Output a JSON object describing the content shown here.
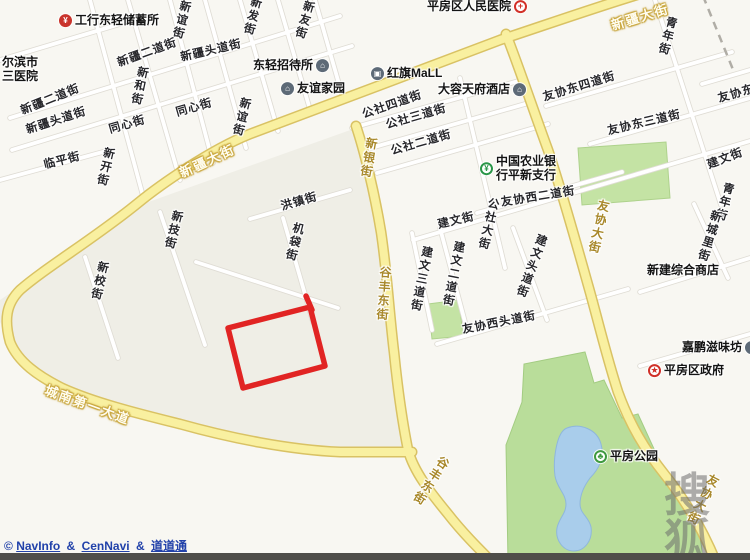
{
  "map": {
    "colors": {
      "road_fill": "#f9f0a0",
      "road_casing": "#d9c264",
      "minor_road": "#ffffff",
      "park_green": "#c4e3a4",
      "water_blue": "#a9cdeb",
      "annotation_red": "#e01212",
      "attribution_blue": "#2242aa",
      "watermark_gray": "#8a8a8a",
      "watermark_red": "#cc4430"
    },
    "annotation": {
      "type": "rectangle",
      "color": "#e01212"
    },
    "street_labels": [
      {
        "text": "新发街",
        "x": 252,
        "y": 16,
        "rot": 14,
        "vertical": true,
        "kind": "street"
      },
      {
        "text": "新谊街",
        "x": 181,
        "y": 20,
        "rot": 14,
        "vertical": true,
        "kind": "street"
      },
      {
        "text": "新友街",
        "x": 304,
        "y": 20,
        "rot": 16,
        "vertical": true,
        "kind": "street"
      },
      {
        "text": "新疆二道街",
        "x": 147,
        "y": 52,
        "rot": -20,
        "vertical": false,
        "kind": "street"
      },
      {
        "text": "新疆头道街",
        "x": 211,
        "y": 50,
        "rot": -13,
        "vertical": false,
        "kind": "street"
      },
      {
        "text": "新和街",
        "x": 139,
        "y": 86,
        "rot": 12,
        "vertical": true,
        "kind": "street"
      },
      {
        "text": "新疆二道街",
        "x": 50,
        "y": 99,
        "rot": -22,
        "vertical": false,
        "kind": "street"
      },
      {
        "text": "同心街",
        "x": 194,
        "y": 107,
        "rot": -16,
        "vertical": false,
        "kind": "street"
      },
      {
        "text": "新疆头道街",
        "x": 56,
        "y": 120,
        "rot": -18,
        "vertical": false,
        "kind": "street"
      },
      {
        "text": "同心街",
        "x": 127,
        "y": 124,
        "rot": -16,
        "vertical": false,
        "kind": "street"
      },
      {
        "text": "新谊街",
        "x": 241,
        "y": 117,
        "rot": 14,
        "vertical": true,
        "kind": "street"
      },
      {
        "text": "临平街",
        "x": 62,
        "y": 160,
        "rot": -14,
        "vertical": false,
        "kind": "street"
      },
      {
        "text": "新开街",
        "x": 105,
        "y": 167,
        "rot": 13,
        "vertical": true,
        "kind": "street"
      },
      {
        "text": "新技街",
        "x": 173,
        "y": 230,
        "rot": 14,
        "vertical": true,
        "kind": "street"
      },
      {
        "text": "新校街",
        "x": 99,
        "y": 281,
        "rot": 13,
        "vertical": true,
        "kind": "street"
      },
      {
        "text": "洪镇街",
        "x": 299,
        "y": 201,
        "rot": -16,
        "vertical": false,
        "kind": "street"
      },
      {
        "text": "机袋街",
        "x": 294,
        "y": 242,
        "rot": 14,
        "vertical": true,
        "kind": "street"
      },
      {
        "text": "公社四道街",
        "x": 392,
        "y": 104,
        "rot": -19,
        "vertical": false,
        "kind": "street"
      },
      {
        "text": "公社三道街",
        "x": 416,
        "y": 116,
        "rot": -16,
        "vertical": false,
        "kind": "street"
      },
      {
        "text": "公社二道街",
        "x": 421,
        "y": 142,
        "rot": -16,
        "vertical": false,
        "kind": "street"
      },
      {
        "text": "建文街",
        "x": 456,
        "y": 220,
        "rot": -13,
        "vertical": false,
        "kind": "street"
      },
      {
        "text": "公社大街",
        "x": 488,
        "y": 224,
        "rot": 13,
        "vertical": true,
        "kind": "street"
      },
      {
        "text": "建文三道街",
        "x": 421,
        "y": 279,
        "rot": 11,
        "vertical": true,
        "kind": "street"
      },
      {
        "text": "建文二道街",
        "x": 453,
        "y": 274,
        "rot": 11,
        "vertical": true,
        "kind": "street"
      },
      {
        "text": "建文头道街",
        "x": 531,
        "y": 266,
        "rot": 20,
        "vertical": true,
        "kind": "street"
      },
      {
        "text": "友协西二道街",
        "x": 538,
        "y": 196,
        "rot": -9,
        "vertical": false,
        "kind": "street"
      },
      {
        "text": "友协西头道街",
        "x": 499,
        "y": 322,
        "rot": -11,
        "vertical": false,
        "kind": "street"
      },
      {
        "text": "友协东四道街",
        "x": 579,
        "y": 86,
        "rot": -17,
        "vertical": false,
        "kind": "street"
      },
      {
        "text": "友协东三道街",
        "x": 644,
        "y": 122,
        "rot": -13,
        "vertical": false,
        "kind": "street"
      },
      {
        "text": "友协东",
        "x": 736,
        "y": 93,
        "rot": -16,
        "vertical": false,
        "kind": "street"
      },
      {
        "text": "青年街",
        "x": 667,
        "y": 36,
        "rot": 15,
        "vertical": true,
        "kind": "street"
      },
      {
        "text": "青年街",
        "x": 724,
        "y": 202,
        "rot": 15,
        "vertical": true,
        "kind": "street"
      },
      {
        "text": "建文街",
        "x": 725,
        "y": 158,
        "rot": -21,
        "vertical": false,
        "kind": "street"
      },
      {
        "text": "新城里街",
        "x": 709,
        "y": 236,
        "rot": 17,
        "vertical": true,
        "kind": "street"
      },
      {
        "text": "新疆大街",
        "x": 640,
        "y": 16,
        "rot": -17,
        "vertical": false,
        "kind": "roadw"
      },
      {
        "text": "新疆大街",
        "x": 207,
        "y": 160,
        "rot": -25,
        "vertical": false,
        "kind": "roadw"
      },
      {
        "text": "新银街",
        "x": 369,
        "y": 158,
        "rot": 10,
        "vertical": true,
        "kind": "road"
      },
      {
        "text": "谷丰东街",
        "x": 384,
        "y": 294,
        "rot": 4,
        "vertical": true,
        "kind": "road"
      },
      {
        "text": "谷丰东街",
        "x": 431,
        "y": 481,
        "rot": 33,
        "vertical": true,
        "kind": "road"
      },
      {
        "text": "友协大街",
        "x": 599,
        "y": 227,
        "rot": 12,
        "vertical": true,
        "kind": "road"
      },
      {
        "text": "友协大街",
        "x": 703,
        "y": 500,
        "rot": 27,
        "vertical": true,
        "kind": "road"
      },
      {
        "text": "城南第一大道",
        "x": 88,
        "y": 404,
        "rot": 20,
        "vertical": false,
        "kind": "roadw"
      }
    ],
    "pois": [
      {
        "id": "icbc-savings",
        "icon": "bank-icon",
        "icon_side": "left",
        "text": "工行东轻储蓄所",
        "x": 59,
        "y": 21
      },
      {
        "id": "third-hospital",
        "text": "尔滨市",
        "text2": "三医院",
        "x": 2,
        "y": 70
      },
      {
        "id": "pingfang-hospital",
        "icon": "hospital-icon",
        "icon_side": "right",
        "text": "平房区人民医院",
        "x": 427,
        "y": 7
      },
      {
        "id": "dongqing-hostel",
        "icon": "inn-icon",
        "icon_side": "right",
        "text": "东轻招待所",
        "x": 253,
        "y": 66
      },
      {
        "id": "youyi-homes",
        "icon": "community-icon",
        "icon_side": "left",
        "text": "友谊家园",
        "x": 281,
        "y": 89
      },
      {
        "id": "hongqi-mall",
        "icon": "mall-icon",
        "icon_side": "left",
        "text": "红旗MaLL",
        "x": 371,
        "y": 74
      },
      {
        "id": "tianfu-hotel",
        "icon": "hotel-icon",
        "icon_side": "right",
        "text": "大容天府酒店",
        "x": 438,
        "y": 90
      },
      {
        "id": "abc-bank-pingxin",
        "icon": "bank-green-icon",
        "icon_side": "left",
        "text": "中国农业银",
        "text2": "行平新支行",
        "x": 480,
        "y": 169
      },
      {
        "id": "xinjian-store",
        "text": "新建综合商店",
        "x": 647,
        "y": 271
      },
      {
        "id": "jiapeng-shop",
        "icon": "shop-icon",
        "icon_side": "right",
        "text": "嘉鹏滋味坊",
        "x": 682,
        "y": 348
      },
      {
        "id": "pingfang-gov",
        "icon": "gov-icon",
        "icon_side": "left",
        "text": "平房区政府",
        "x": 648,
        "y": 371
      },
      {
        "id": "pingfang-park",
        "icon": "park-icon",
        "icon_side": "left",
        "text": "平房公园",
        "x": 594,
        "y": 457
      }
    ],
    "icon_glyphs": {
      "bank-icon": "¥",
      "hospital-icon": "+",
      "inn-icon": "⌂",
      "community-icon": "⌂",
      "hotel-icon": "⌂",
      "mall-icon": "▣",
      "shop-icon": "▪",
      "bank-green-icon": "¥",
      "gov-icon": "★",
      "park-icon": "♣"
    },
    "watermark": {
      "logo_text": "搜狐",
      "url_text": "WWW.F"
    },
    "attribution": {
      "copyright": "©",
      "provider1": "NavInfo",
      "amp1": "&",
      "provider2": "CenNavi",
      "amp2": "&",
      "provider3": "道道通"
    }
  }
}
